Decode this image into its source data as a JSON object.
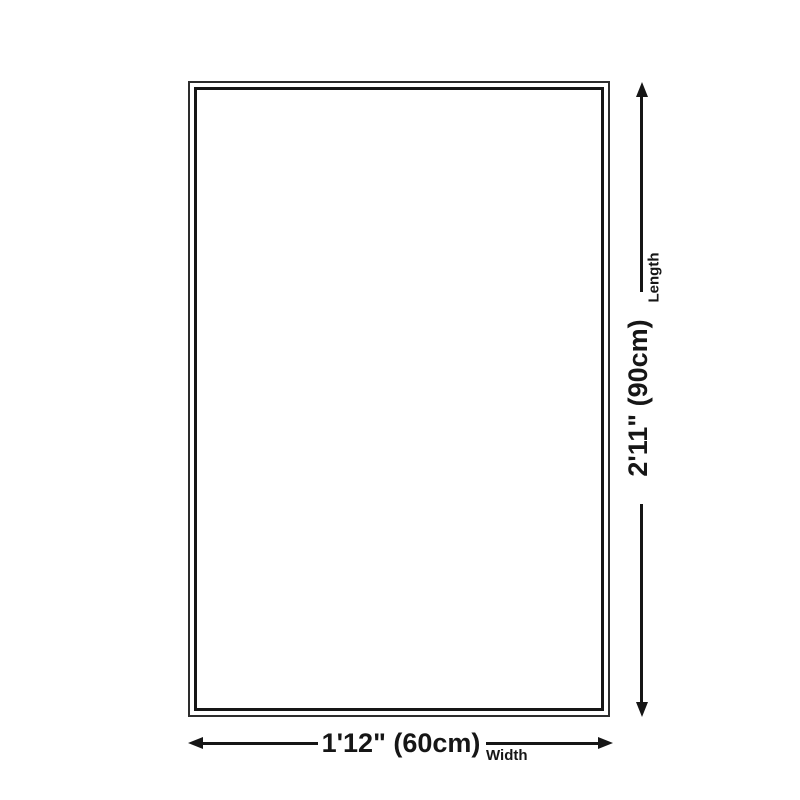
{
  "page": {
    "background_color": "#ffffff",
    "ink_color": "#161616"
  },
  "diagram": {
    "type": "product-size-diagram",
    "rug": {
      "border_style": "double-line rectangle"
    },
    "width_dimension": {
      "value": "1'12\" (60cm)",
      "label": "Width"
    },
    "length_dimension": {
      "value": "2'11\" (90cm)",
      "label": "Length"
    }
  }
}
